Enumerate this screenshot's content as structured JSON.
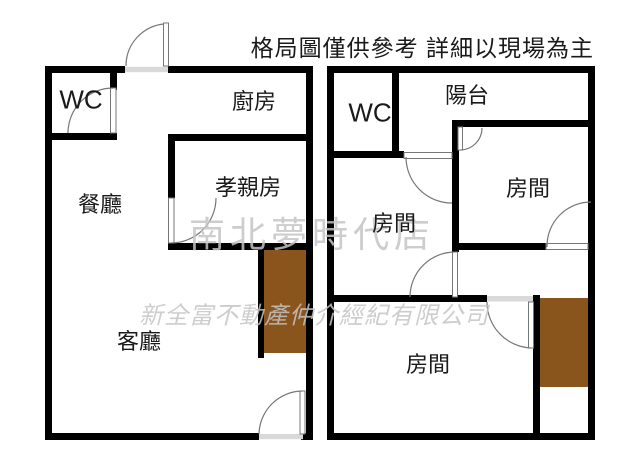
{
  "disclaimer": "格局圖僅供參考 詳細以現場為主",
  "watermarks": {
    "store_name": "南北夢時代店",
    "company_name": "新全富不動產仲介經紀有限公司"
  },
  "plans": {
    "left": {
      "wc": "WC",
      "kitchen": "廚房",
      "dining": "餐廳",
      "parents_room": "孝親房",
      "living_room": "客廳"
    },
    "right": {
      "wc": "WC",
      "balcony": "陽台",
      "room_top_right": "房間",
      "room_middle": "房間",
      "room_bottom": "房間"
    }
  },
  "colors": {
    "wall": "#000000",
    "room_label": "#1a1a1a",
    "disclaimer_text": "#1a1a1a",
    "balcony_fill": "#8a541d",
    "watermark": "#c5c5c5",
    "door_line": "#777777",
    "threshold_fill": "#d9d9d9"
  }
}
